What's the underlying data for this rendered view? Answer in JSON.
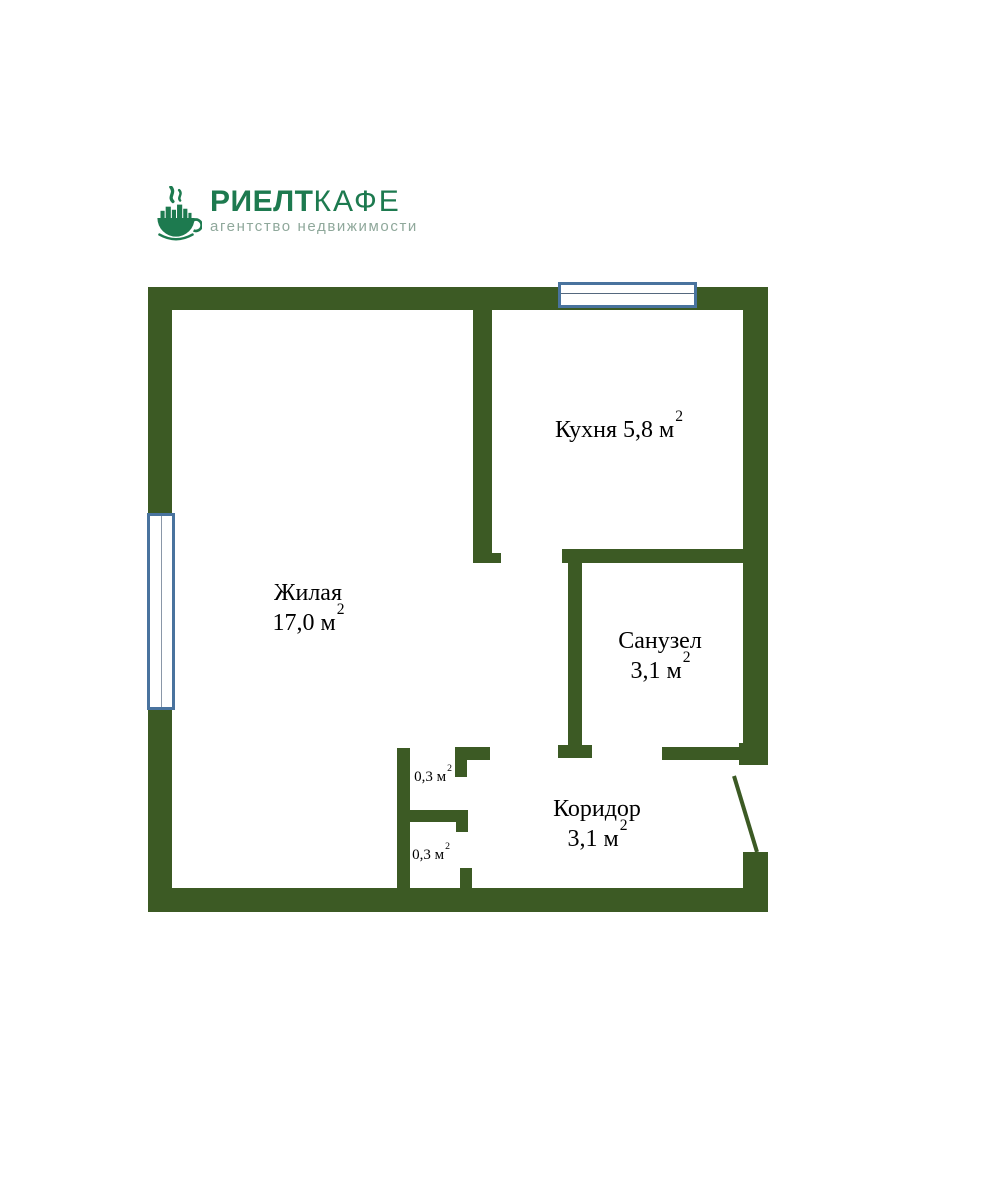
{
  "logo": {
    "brand_bold": "РИЕЛТ",
    "brand_light": "КАФЕ",
    "subtitle": "агентство недвижимости",
    "colors": {
      "brand": "#1d7a4f",
      "subtitle": "#8fa89b"
    }
  },
  "floor_plan": {
    "colors": {
      "wall": "#3c5a24",
      "window_frame": "#49739e",
      "label_text": "#000000"
    },
    "features": {
      "windows": [
        "window-top",
        "window-left"
      ],
      "doors": [
        "entrance-door",
        "bathroom-door",
        "kitchen-door",
        "closet-doors"
      ]
    },
    "rooms": {
      "living": {
        "name": "Жилая",
        "area": "17,0 м",
        "area_sup": "2"
      },
      "kitchen": {
        "name": "Кухня",
        "area": "5,8 м",
        "area_sup": "2"
      },
      "bathroom": {
        "name": "Санузел",
        "area": "3,1 м",
        "area_sup": "2"
      },
      "corridor": {
        "name": "Коридор",
        "area": "3,1 м",
        "area_sup": "2"
      },
      "closet_upper": {
        "area": "0,3 м",
        "area_sup": "2"
      },
      "closet_lower": {
        "area": "0,3 м",
        "area_sup": "2"
      }
    }
  }
}
